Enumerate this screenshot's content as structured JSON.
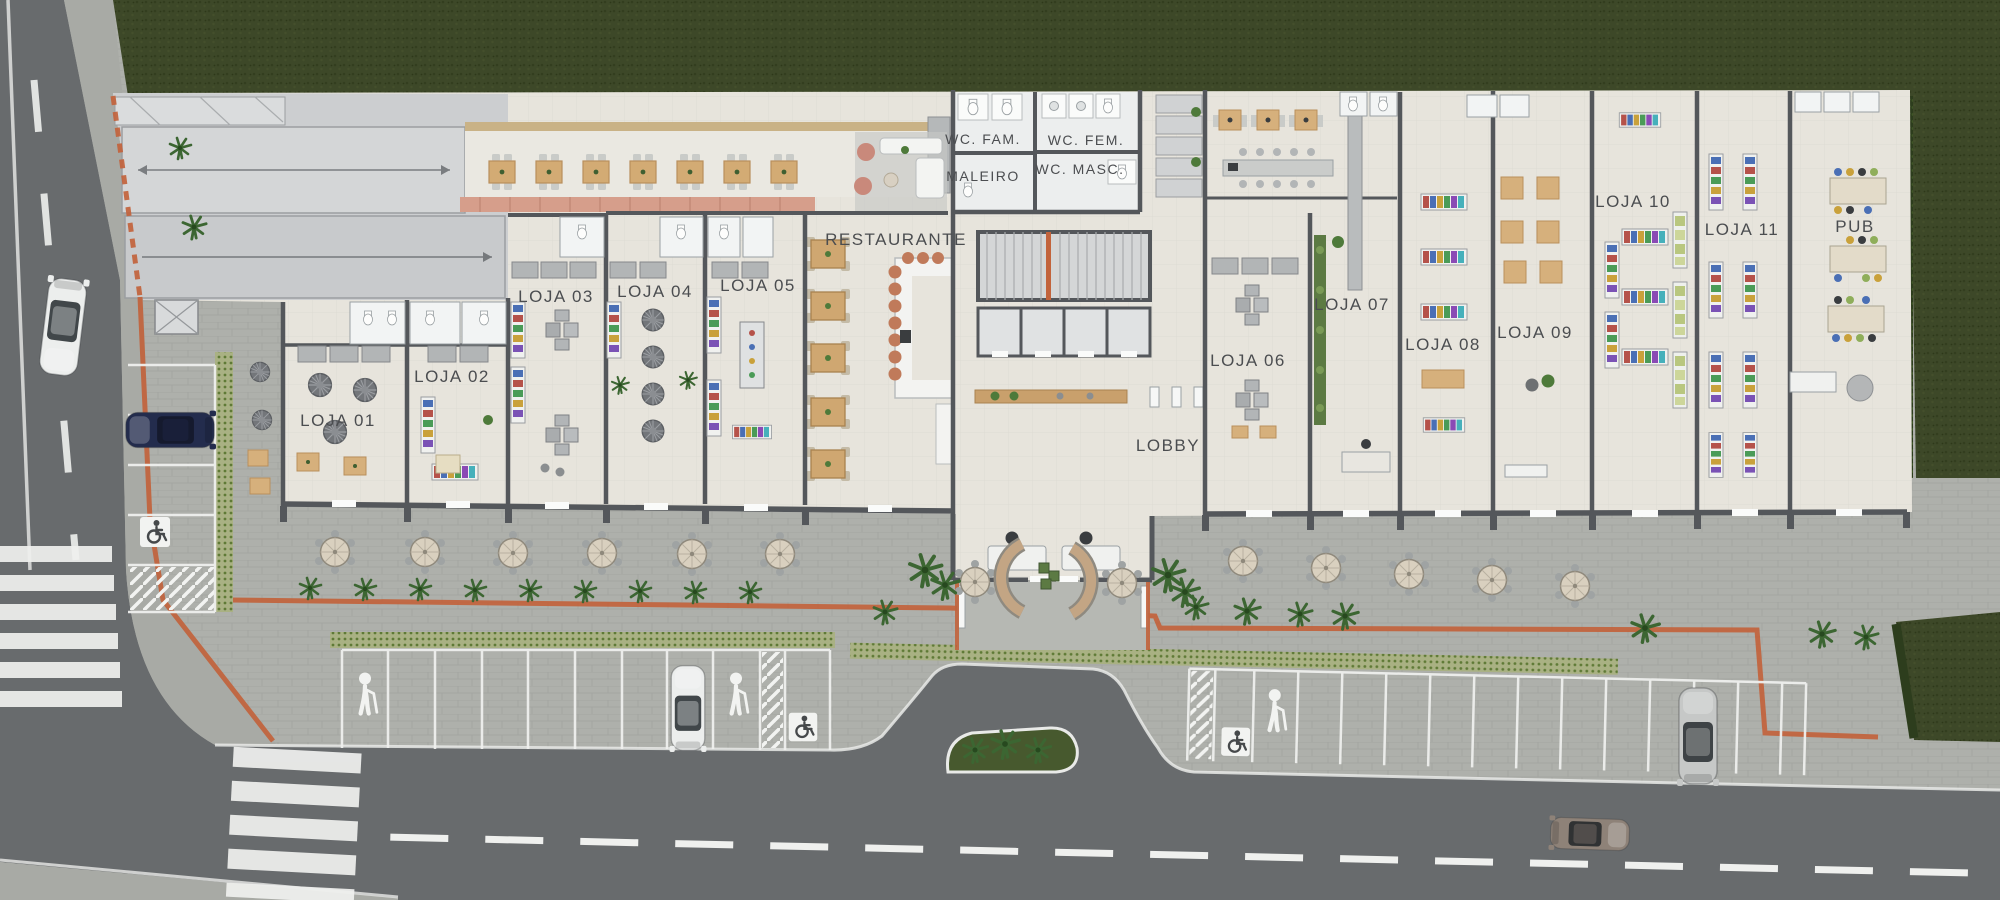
{
  "plan": {
    "type": "shopping-strip-site-plan",
    "labels": {
      "loja01": "LOJA 01",
      "loja02": "LOJA 02",
      "loja03": "LOJA 03",
      "loja04": "LOJA 04",
      "loja05": "LOJA 05",
      "loja06": "LOJA 06",
      "loja07": "LOJA 07",
      "loja08": "LOJA 08",
      "loja09": "LOJA 09",
      "loja10": "LOJA 10",
      "loja11": "LOJA 11",
      "restaurante": "RESTAURANTE",
      "maleiro": "MALEIRO",
      "wc_fam": "WC. FAM.",
      "wc_fem": "WC. FEM.",
      "wc_masc": "WC. MASC.",
      "lobby": "LOBBY",
      "pub": "PUB"
    },
    "icons": {
      "accessible_parking": "wheelchair-icon",
      "senior_parking": "elderly-person-icon"
    },
    "colors": {
      "grass": "#3d4828",
      "hedge": "#2d3d1d",
      "asphalt": "#686b6d",
      "plaza": "#aeb0ab",
      "sidewalk": "#a8aaa5",
      "building_floor": "#e7e4dc",
      "service_floor": "#ccced0",
      "wall": "#54575b",
      "accent_orange": "#c2633c",
      "tactile_green": "#93a268",
      "terrace_salmon": "#d69e8b",
      "wood": "#cfa771",
      "umbrella": "#d9d0bf",
      "car_navy": "#232c4d",
      "car_white": "#eceeed",
      "car_silver": "#c6c8c7",
      "car_taupe": "#8e8278"
    }
  }
}
